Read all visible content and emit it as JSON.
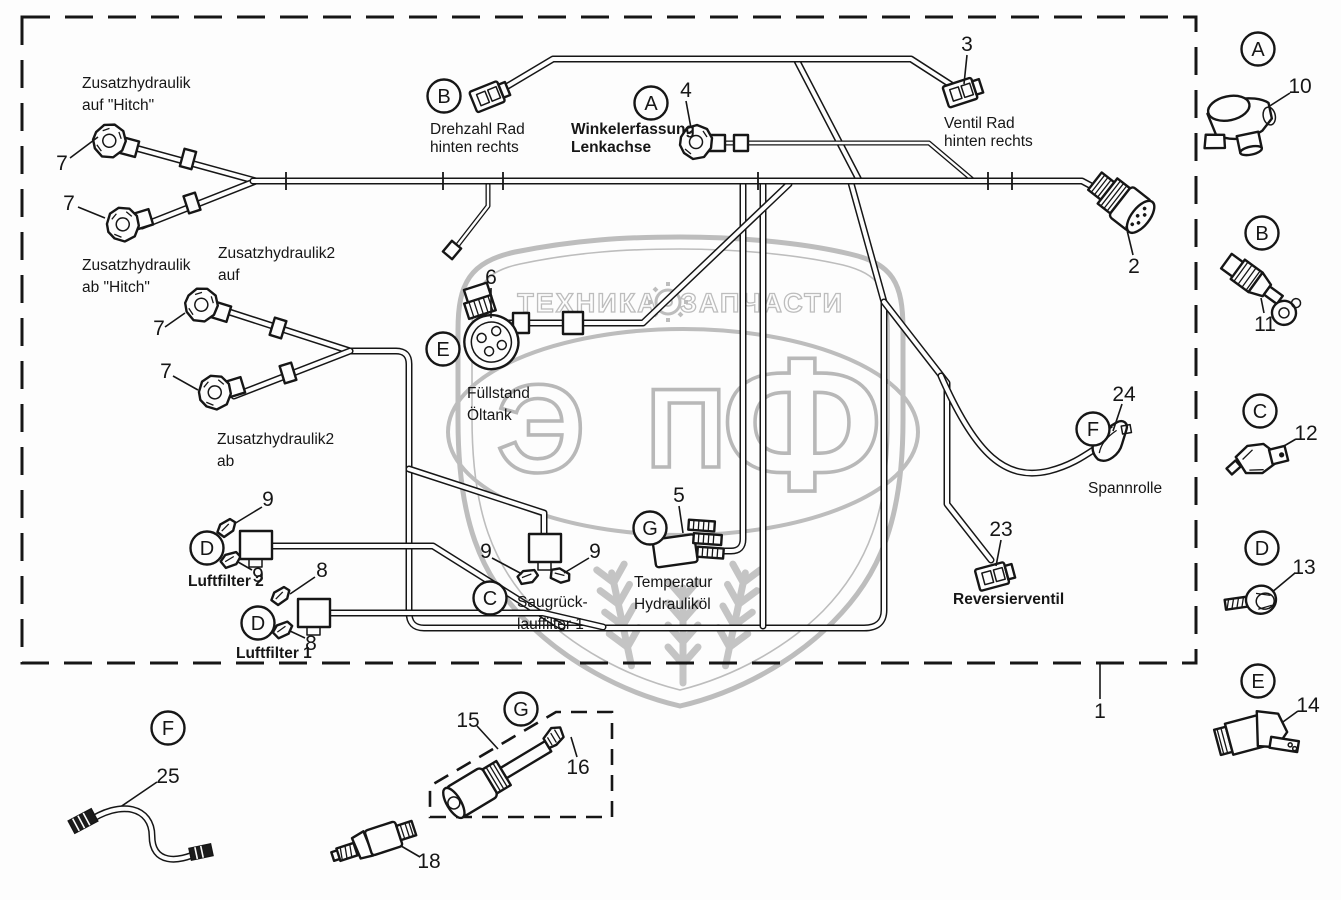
{
  "colors": {
    "line": "#161616",
    "watermark": "#bdbdbd",
    "background": "#fdfdfd"
  },
  "watermark": {
    "top_left": "ТЕХНИКА",
    "top_right": "ЗАПЧАСТИ",
    "letters": [
      "Э",
      "П",
      "Ф"
    ]
  },
  "ref_letters": {
    "A": "A",
    "B": "B",
    "C": "C",
    "D": "D",
    "E": "E",
    "F": "F",
    "G": "G"
  },
  "part_numbers": {
    "n1": "1",
    "n2": "2",
    "n3": "3",
    "n4": "4",
    "n5": "5",
    "n6": "6",
    "n7": "7",
    "n8": "8",
    "n9": "9",
    "n10": "10",
    "n11": "11",
    "n12": "12",
    "n13": "13",
    "n14": "14",
    "n15": "15",
    "n16": "16",
    "n18": "18",
    "n23": "23",
    "n24": "24",
    "n25": "25"
  },
  "labels": {
    "zusatz_auf": [
      "Zusatzhydraulik",
      "auf \"Hitch\""
    ],
    "zusatz_ab": [
      "Zusatzhydraulik",
      "ab \"Hitch\""
    ],
    "zusatz2_auf": [
      "Zusatzhydraulik2",
      "auf"
    ],
    "zusatz2_ab": [
      "Zusatzhydraulik2",
      "ab"
    ],
    "drehzahl": [
      "Drehzahl Rad",
      "hinten rechts"
    ],
    "winkel": [
      "Winkelerfassung",
      "Lenkachse"
    ],
    "ventil": [
      "Ventil Rad",
      "hinten rechts"
    ],
    "fuellstand": [
      "Füllstand",
      "Öltank"
    ],
    "luftfilter2": [
      "Luftfilter 2"
    ],
    "luftfilter1": [
      "Luftfilter 1"
    ],
    "saugrueck": [
      "Saugrück-",
      "lauffilter 1"
    ],
    "temperatur": [
      "Temperatur",
      "Hydrauliköl"
    ],
    "spannrolle": [
      "Spannrolle"
    ],
    "reversier": [
      "Reversierventil"
    ]
  }
}
